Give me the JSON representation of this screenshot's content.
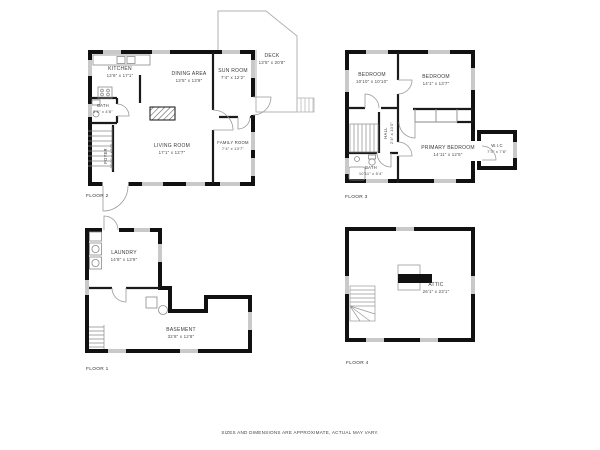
{
  "disclaimer": "SIZES AND DIMENSIONS ARE APPROXIMATE, ACTUAL MAY VARY.",
  "colors": {
    "wall": "#111111",
    "window": "#c9c9c9",
    "thin_line": "#999999",
    "text": "#3a3a3a",
    "background": "#ffffff"
  },
  "floors": [
    {
      "label": "FLOOR 2",
      "rooms": [
        {
          "name": "KITCHEN",
          "dims": "12'6\" x 17'1\""
        },
        {
          "name": "DINING AREA",
          "dims": "13'5\" x 13'9\""
        },
        {
          "name": "SUN ROOM",
          "dims": "7'4\" x 12'2\""
        },
        {
          "name": "DECK",
          "dims": "13'5\" x 20'8\""
        },
        {
          "name": "BATH",
          "dims": "5'6\" x 4'8\""
        },
        {
          "name": "FOYER",
          "dims": "10'0\" x 4'10\""
        },
        {
          "name": "LIVING ROOM",
          "dims": "17'1\" x 12'7\""
        },
        {
          "name": "FAMILY ROOM",
          "dims": "7'4\" x 13'7\""
        }
      ]
    },
    {
      "label": "FLOOR 3",
      "rooms": [
        {
          "name": "BEDROOM",
          "dims": "10'10\" x 10'10\""
        },
        {
          "name": "BEDROOM",
          "dims": "14'1\" x 13'7\""
        },
        {
          "name": "HALL",
          "dims": "2'4\" x 10'0\""
        },
        {
          "name": "PRIMARY BEDROOM",
          "dims": "14'11\" x 12'5\""
        },
        {
          "name": "W.I.C",
          "dims": "7'3\" x 7'8\""
        },
        {
          "name": "BATH",
          "dims": "10'11\" x 5'4\""
        }
      ]
    },
    {
      "label": "FLOOR 1",
      "rooms": [
        {
          "name": "LAUNDRY",
          "dims": "14'8\" x 13'9\""
        },
        {
          "name": "BASEMENT",
          "dims": "32'8\" x 12'8\""
        }
      ]
    },
    {
      "label": "FLOOR 4",
      "rooms": [
        {
          "name": "ATTIC",
          "dims": "26'1\" x 23'1\""
        }
      ]
    }
  ]
}
